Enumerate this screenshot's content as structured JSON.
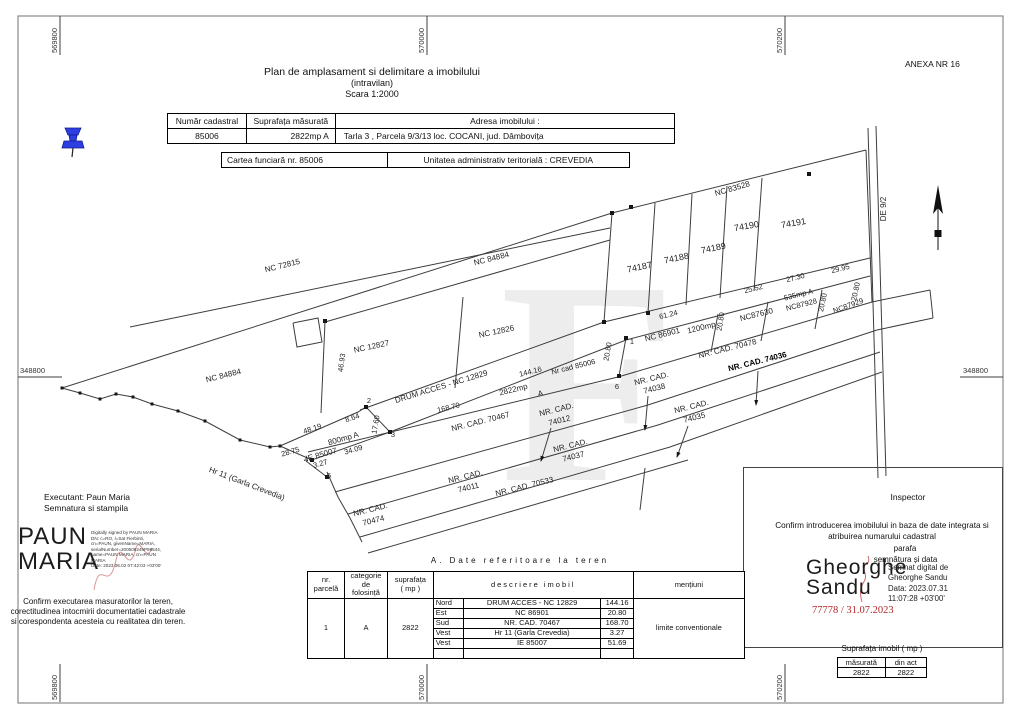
{
  "page": {
    "anexa": "ANEXA NR 16"
  },
  "title": {
    "line1": "Plan de amplasament si delimitare a imobilului",
    "line2": "(intravilan)",
    "line3": "Scara 1:2000"
  },
  "header_table": {
    "c1h": "Număr cadastral",
    "c2h": "Suprafața măsurată",
    "c3h": "Adresa imobilului :",
    "c1": "85006",
    "c2": "2822mp A",
    "c3": "Tarla  3 , Parcela 9/3/13 loc. COCANI, jud. Dâmbovița"
  },
  "cf": {
    "left": "Cartea funciară  nr.  85006",
    "right": "Unitatea administrativ teritorială :   CREVEDIA"
  },
  "grid": {
    "top": [
      "569800",
      "570000",
      "570200"
    ],
    "bottom": [
      "569800",
      "570000",
      "570200"
    ],
    "left": "348800",
    "right": "348800"
  },
  "map": {
    "lines": [
      [
        [
          62,
          388
        ],
        [
          612,
          213
        ],
        [
          866,
          150
        ]
      ],
      [
        [
          130,
          327
        ],
        [
          610,
          228
        ]
      ],
      [
        [
          325,
          322
        ],
        [
          610,
          240
        ]
      ],
      [
        [
          325,
          322
        ],
        [
          321,
          413
        ]
      ],
      [
        [
          463,
          297
        ],
        [
          455,
          388
        ]
      ],
      [
        [
          360,
          410
        ],
        [
          604,
          322
        ],
        [
          870,
          258
        ]
      ],
      [
        [
          390,
          432
        ],
        [
          626,
          340
        ],
        [
          870,
          276
        ]
      ],
      [
        [
          626,
          338
        ],
        [
          619,
          376
        ]
      ],
      [
        [
          308,
          452
        ],
        [
          618,
          377
        ],
        [
          872,
          302
        ],
        [
          930,
          290
        ]
      ],
      [
        [
          335,
          492
        ],
        [
          648,
          405
        ],
        [
          877,
          330
        ],
        [
          933,
          318
        ]
      ],
      [
        [
          930,
          290
        ],
        [
          933,
          318
        ]
      ],
      [
        [
          348,
          514
        ],
        [
          658,
          425
        ],
        [
          880,
          352
        ]
      ],
      [
        [
          360,
          537
        ],
        [
          670,
          447
        ],
        [
          882,
          372
        ]
      ],
      [
        [
          368,
          553
        ],
        [
          688,
          460
        ]
      ],
      [
        [
          327,
          472
        ],
        [
          338,
          497
        ],
        [
          350,
          518
        ],
        [
          362,
          542
        ]
      ],
      [
        [
          612,
          213
        ],
        [
          604,
          322
        ]
      ],
      [
        [
          655,
          203
        ],
        [
          648,
          313
        ]
      ],
      [
        [
          692,
          194
        ],
        [
          686,
          305
        ]
      ],
      [
        [
          727,
          186
        ],
        [
          720,
          298
        ]
      ],
      [
        [
          762,
          178
        ],
        [
          754,
          291
        ]
      ],
      [
        [
          866,
          150
        ],
        [
          872,
          302
        ]
      ],
      [
        [
          718,
          314
        ],
        [
          711,
          352
        ]
      ],
      [
        [
          768,
          302
        ],
        [
          761,
          341
        ]
      ],
      [
        [
          822,
          290
        ],
        [
          815,
          329
        ]
      ],
      [
        [
          645,
          468
        ],
        [
          640,
          510
        ]
      ],
      [
        [
          280,
          446
        ],
        [
          358,
          412
        ],
        [
          366,
          407
        ],
        [
          390,
          432
        ],
        [
          312,
          460
        ],
        [
          280,
          446
        ]
      ],
      [
        [
          306,
          461
        ],
        [
          327,
          477
        ]
      ],
      [
        [
          293,
          323
        ],
        [
          318,
          318
        ],
        [
          322,
          342
        ],
        [
          297,
          347
        ],
        [
          293,
          323
        ]
      ],
      [
        [
          868,
          128
        ],
        [
          878,
          478
        ]
      ],
      [
        [
          876,
          126
        ],
        [
          886,
          476
        ]
      ]
    ],
    "creek": [
      [
        62,
        388
      ],
      [
        80,
        393
      ],
      [
        100,
        399
      ],
      [
        116,
        394
      ],
      [
        133,
        397
      ],
      [
        152,
        404
      ],
      [
        178,
        411
      ],
      [
        205,
        421
      ],
      [
        240,
        440
      ],
      [
        270,
        447
      ],
      [
        280,
        446
      ]
    ],
    "dots": [
      [
        631,
        207
      ],
      [
        809,
        174
      ],
      [
        626,
        338
      ],
      [
        619,
        376
      ],
      [
        325,
        321
      ],
      [
        366,
        407
      ],
      [
        390,
        432
      ],
      [
        312,
        460
      ],
      [
        327,
        477
      ],
      [
        604,
        322
      ],
      [
        648,
        313
      ],
      [
        612,
        213
      ]
    ],
    "arrows": [
      [
        [
          648,
          396
        ],
        [
          645,
          430
        ]
      ],
      [
        [
          758,
          371
        ],
        [
          756,
          405
        ]
      ],
      [
        [
          551,
          428
        ],
        [
          541,
          461
        ]
      ],
      [
        [
          688,
          426
        ],
        [
          677,
          457
        ]
      ]
    ],
    "labels": [
      {
        "t": "NC 72815",
        "x": 283,
        "y": 268,
        "r": -14
      },
      {
        "t": "NC 84884",
        "x": 492,
        "y": 261,
        "r": -14
      },
      {
        "t": "NC 84884",
        "x": 224,
        "y": 378,
        "r": -14
      },
      {
        "t": "NC 12827",
        "x": 372,
        "y": 349,
        "r": -12
      },
      {
        "t": "NC 12826",
        "x": 497,
        "y": 334,
        "r": -12
      },
      {
        "t": "NC 83528",
        "x": 733,
        "y": 191,
        "r": -16
      },
      {
        "t": "74187",
        "x": 640,
        "y": 270,
        "r": -12,
        "s": 9
      },
      {
        "t": "74188",
        "x": 677,
        "y": 261,
        "r": -12,
        "s": 9
      },
      {
        "t": "74189",
        "x": 714,
        "y": 251,
        "r": -12,
        "s": 9
      },
      {
        "t": "74190",
        "x": 747,
        "y": 229,
        "r": -10,
        "s": 9
      },
      {
        "t": "74191",
        "x": 794,
        "y": 226,
        "r": -10,
        "s": 9
      },
      {
        "t": "DE 9/2",
        "x": 886,
        "y": 209,
        "r": -90
      },
      {
        "t": "DRUM ACCES - NC 12829",
        "x": 442,
        "y": 389,
        "r": -17
      },
      {
        "t": "144.16",
        "x": 531,
        "y": 374,
        "r": -14,
        "s": 7.5
      },
      {
        "t": "Nr cad 85006",
        "x": 574,
        "y": 369,
        "r": -14,
        "s": 7.5
      },
      {
        "t": "2822mp",
        "x": 514,
        "y": 392,
        "r": -14
      },
      {
        "t": "A",
        "x": 541,
        "y": 396,
        "r": -14
      },
      {
        "t": "20.80",
        "x": 610,
        "y": 352,
        "r": -80,
        "s": 7.5
      },
      {
        "t": "1",
        "x": 632,
        "y": 344,
        "r": 0,
        "s": 7.5
      },
      {
        "t": "6",
        "x": 617,
        "y": 389,
        "r": 0,
        "s": 7.5
      },
      {
        "t": "61.24",
        "x": 669,
        "y": 317,
        "r": -14,
        "s": 7.5
      },
      {
        "t": "NC 86901",
        "x": 663,
        "y": 337,
        "r": -14
      },
      {
        "t": "1200mp",
        "x": 702,
        "y": 330,
        "r": -14
      },
      {
        "t": "20.80",
        "x": 723,
        "y": 322,
        "r": -80,
        "s": 7.5
      },
      {
        "t": "NC87630",
        "x": 757,
        "y": 317,
        "r": -14
      },
      {
        "t": "25.52",
        "x": 754,
        "y": 291,
        "r": -14,
        "s": 7.5
      },
      {
        "t": "27.30",
        "x": 796,
        "y": 280,
        "r": -14,
        "s": 7.5
      },
      {
        "t": "535mp A",
        "x": 799,
        "y": 297,
        "r": -14,
        "s": 7.5
      },
      {
        "t": "NC87928",
        "x": 802,
        "y": 307,
        "r": -14,
        "s": 7.5
      },
      {
        "t": "20.80",
        "x": 825,
        "y": 303,
        "r": -78,
        "s": 7.5
      },
      {
        "t": "29.95",
        "x": 841,
        "y": 271,
        "r": -14,
        "s": 7.5
      },
      {
        "t": "20.80",
        "x": 858,
        "y": 292,
        "r": -78,
        "s": 7.5
      },
      {
        "t": "NC87929",
        "x": 849,
        "y": 308,
        "r": -20,
        "s": 7.5
      },
      {
        "t": "NR.  CAD.  70478",
        "x": 728,
        "y": 351,
        "r": -14
      },
      {
        "t": "NR.  CAD.  74036",
        "x": 758,
        "y": 364,
        "r": -14,
        "b": 1
      },
      {
        "t": "NR.  CAD.",
        "x": 652,
        "y": 381,
        "r": -14
      },
      {
        "t": "74038",
        "x": 655,
        "y": 391,
        "r": -14
      },
      {
        "t": "NR.  CAD.",
        "x": 692,
        "y": 409,
        "r": -14
      },
      {
        "t": "74035",
        "x": 695,
        "y": 420,
        "r": -14
      },
      {
        "t": "NR.  CAD.",
        "x": 557,
        "y": 412,
        "r": -14
      },
      {
        "t": "74012",
        "x": 560,
        "y": 423,
        "r": -14
      },
      {
        "t": "NR.  CAD.",
        "x": 571,
        "y": 448,
        "r": -14
      },
      {
        "t": "74037",
        "x": 574,
        "y": 459,
        "r": -14
      },
      {
        "t": "NR.  CAD.",
        "x": 466,
        "y": 479,
        "r": -14
      },
      {
        "t": "74011",
        "x": 469,
        "y": 490,
        "r": -14
      },
      {
        "t": "NR.  CAD.  70533",
        "x": 525,
        "y": 489,
        "r": -14
      },
      {
        "t": "NR.  CAD.",
        "x": 371,
        "y": 512,
        "r": -14
      },
      {
        "t": "70474",
        "x": 374,
        "y": 523,
        "r": -14
      },
      {
        "t": "NR.  CAD.  70467",
        "x": 481,
        "y": 424,
        "r": -14
      },
      {
        "t": "168.70",
        "x": 449,
        "y": 410,
        "r": -14,
        "s": 7.5
      },
      {
        "t": "2",
        "x": 369,
        "y": 403,
        "r": 0,
        "s": 7.5
      },
      {
        "t": "17.60",
        "x": 378,
        "y": 425,
        "r": -80,
        "s": 7.5
      },
      {
        "t": "3",
        "x": 393,
        "y": 437,
        "r": 0,
        "s": 7.5
      },
      {
        "t": "48.19",
        "x": 313,
        "y": 431,
        "r": -18,
        "s": 7.5
      },
      {
        "t": "8.64",
        "x": 353,
        "y": 420,
        "r": -18,
        "s": 7.5
      },
      {
        "t": "800mp A",
        "x": 344,
        "y": 441,
        "r": -16
      },
      {
        "t": "34.09",
        "x": 354,
        "y": 452,
        "r": -16,
        "s": 7.5
      },
      {
        "t": "IE 85007",
        "x": 322,
        "y": 457,
        "r": -16
      },
      {
        "t": "28.75",
        "x": 291,
        "y": 454,
        "r": -16,
        "s": 7.5
      },
      {
        "t": "4",
        "x": 306,
        "y": 462,
        "r": 0,
        "s": 7.5
      },
      {
        "t": "3.27",
        "x": 321,
        "y": 466,
        "r": -16,
        "s": 7.5
      },
      {
        "t": "5",
        "x": 329,
        "y": 478,
        "r": 0,
        "s": 7.5
      },
      {
        "t": "Hr 11 (Garla Crevedia)",
        "x": 246,
        "y": 486,
        "r": 21
      },
      {
        "t": "46.93",
        "x": 344,
        "y": 363,
        "r": -82,
        "s": 7.5
      }
    ]
  },
  "executant": {
    "line1": "Executant: Paun Maria",
    "line2": "Semnatura si stampila",
    "sig_name": "PAUN\nMARIA",
    "sig_details": "Digitally signed by PAUN MARIA\nDN: c=RO, l=Sat Fierbinti,\ncn=PAUN, givenName=MARIA,\nserialNumber=200506249P98544,\nname=PAUN MARIA, cn=PAUN\nMARIA\nDate: 2023.06.02 07:42:03 +03'00'",
    "confirm": "Confirm executarea masuratorilor la teren, corectitudinea intocmirii documentatiei cadastrale si corespondenta acesteia cu realitatea din teren."
  },
  "inspector": {
    "title": "Inspector",
    "confirm": "Confirm introducerea imobilului in baza de date integrata si atribuirea numarului cadastral",
    "parafa": "parafa",
    "semnatura": "semnătura și data",
    "sig_name": "Gheorghe\nSandu",
    "sig_details": "Semnat digital de\nGheorghe Sandu\nData: 2023.07.31\n11:07:28 +03'00'",
    "reg_number": "77778 / 31.07.2023"
  },
  "teren": {
    "title": "A. Date referitoare la teren",
    "h_nr": "nr.\nparcelă",
    "h_cat": "categorie\nde\nfolosință",
    "h_sup": "suprafața\n( mp )",
    "h_desc": "descriere imobil",
    "h_men": "mențiuni",
    "nr": "1",
    "cat": "A",
    "sup": "2822",
    "rows": [
      [
        "Nord",
        "DRUM ACCES - NC 12829",
        "144.16"
      ],
      [
        "Est",
        "NC 86901",
        "20.80"
      ],
      [
        "Sud",
        "NR. CAD. 70467",
        "168.70"
      ],
      [
        "Vest",
        "Hr 11 (Garla Crevedia)",
        "3.27"
      ],
      [
        "Vest",
        "IE 85007",
        "51.69"
      ],
      [
        "",
        "",
        ""
      ]
    ],
    "mentiuni": "limite conventionale"
  },
  "sup_table": {
    "title": "Suprafața  imobil  ( mp )",
    "h1": "măsurată",
    "h2": "din act",
    "v1": "2822",
    "v2": "2822"
  }
}
